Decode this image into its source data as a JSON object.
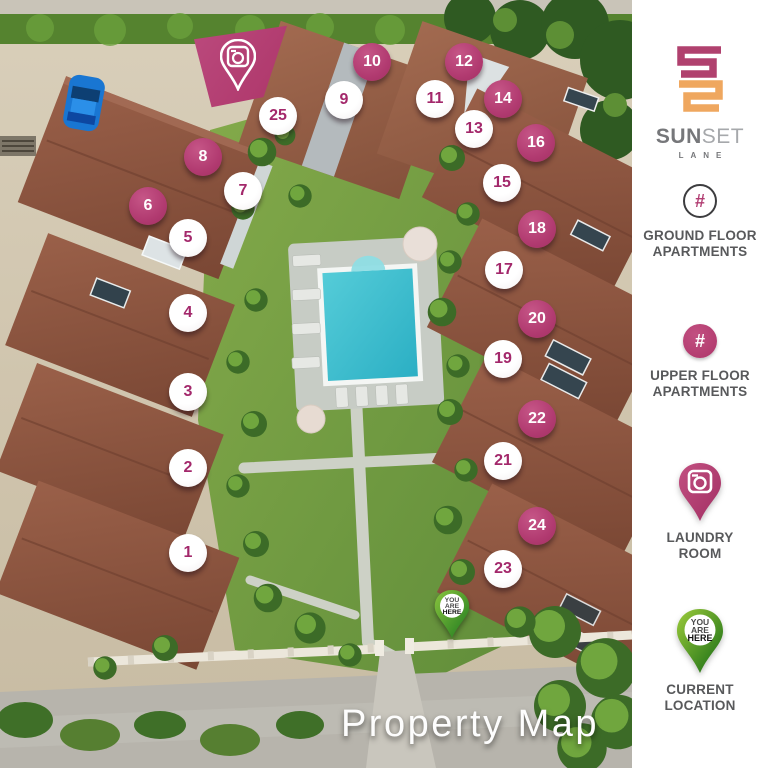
{
  "caption": "Property Map",
  "brand": {
    "word_main": "SUN",
    "word_accent": "SET",
    "word_sub": "LANE"
  },
  "legend": {
    "ground": {
      "symbol": "#",
      "line1": "GROUND FLOOR",
      "line2": "APARTMENTS"
    },
    "upper": {
      "symbol": "#",
      "line1": "UPPER FLOOR",
      "line2": "APARTMENTS"
    },
    "laundry": {
      "line1": "LAUNDRY",
      "line2": "ROOM"
    },
    "current": {
      "line1": "CURRENT",
      "line2": "LOCATION"
    }
  },
  "you_are_here": {
    "you": "YOU",
    "are": "ARE",
    "here": "HERE"
  },
  "colors": {
    "magenta": "#b23e73",
    "logo_crimson": "#b0416e",
    "logo_orange": "#efa75f",
    "pin_green_light": "#8ac43e",
    "pin_green_dark": "#1e7a1f",
    "pool": "#3fc0cf",
    "label_gray": "#58595b"
  },
  "map": {
    "markers": [
      {
        "n": "1",
        "floor": "ground",
        "x": 188,
        "y": 553
      },
      {
        "n": "2",
        "floor": "ground",
        "x": 188,
        "y": 468
      },
      {
        "n": "3",
        "floor": "ground",
        "x": 188,
        "y": 392
      },
      {
        "n": "4",
        "floor": "ground",
        "x": 188,
        "y": 313
      },
      {
        "n": "5",
        "floor": "ground",
        "x": 188,
        "y": 238
      },
      {
        "n": "6",
        "floor": "upper",
        "x": 148,
        "y": 206
      },
      {
        "n": "7",
        "floor": "ground",
        "x": 243,
        "y": 191
      },
      {
        "n": "8",
        "floor": "upper",
        "x": 203,
        "y": 157
      },
      {
        "n": "9",
        "floor": "ground",
        "x": 344,
        "y": 100
      },
      {
        "n": "10",
        "floor": "upper",
        "x": 372,
        "y": 62
      },
      {
        "n": "11",
        "floor": "ground",
        "x": 435,
        "y": 99
      },
      {
        "n": "12",
        "floor": "upper",
        "x": 464,
        "y": 62
      },
      {
        "n": "13",
        "floor": "ground",
        "x": 474,
        "y": 129
      },
      {
        "n": "14",
        "floor": "upper",
        "x": 503,
        "y": 99
      },
      {
        "n": "15",
        "floor": "ground",
        "x": 502,
        "y": 183
      },
      {
        "n": "16",
        "floor": "upper",
        "x": 536,
        "y": 143
      },
      {
        "n": "17",
        "floor": "ground",
        "x": 504,
        "y": 270
      },
      {
        "n": "18",
        "floor": "upper",
        "x": 537,
        "y": 229
      },
      {
        "n": "19",
        "floor": "ground",
        "x": 503,
        "y": 359
      },
      {
        "n": "20",
        "floor": "upper",
        "x": 537,
        "y": 319
      },
      {
        "n": "21",
        "floor": "ground",
        "x": 503,
        "y": 461
      },
      {
        "n": "22",
        "floor": "upper",
        "x": 537,
        "y": 419
      },
      {
        "n": "23",
        "floor": "ground",
        "x": 503,
        "y": 569
      },
      {
        "n": "24",
        "floor": "upper",
        "x": 537,
        "y": 526
      },
      {
        "n": "25",
        "floor": "ground",
        "x": 278,
        "y": 116
      }
    ]
  }
}
